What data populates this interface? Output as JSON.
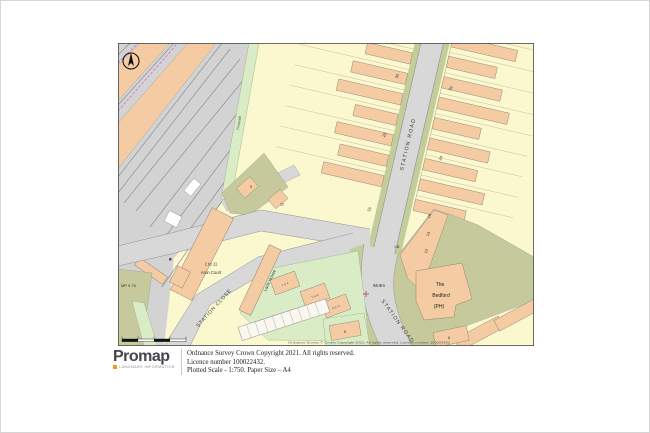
{
  "map": {
    "roads": {
      "station_road": "STATION ROAD",
      "station_road_lower": "STATION ROAD",
      "station_close": "STATION CLOSE",
      "footpath": "Footpath"
    },
    "buildings": {
      "arun_line1": "1 to 11",
      "arun_line2": "Arun Court",
      "lane_house": "Lane House",
      "bedford_line1": "The",
      "bedford_line2": "Bedford",
      "bedford_line3": "(PH)"
    },
    "markers": {
      "milepost": "MP 9.75",
      "letter_box": "LB",
      "spot_height": "66.9m"
    },
    "house_numbers": {
      "w1": "33",
      "w2": "25",
      "w3": "15",
      "e1": "34",
      "e2": "24",
      "e3": "16",
      "e4": "14",
      "e5": "12",
      "c1": "9",
      "c2": "12",
      "s1": "5",
      "s2": "6"
    },
    "flat_labels": [
      "1 to 4",
      "5 to 8",
      "9 to 12"
    ],
    "edge_copyright": "Ordnance Survey © Crown Copyright 2021. All rights reserved. Licence number 100022432",
    "colors": {
      "building": "#f4cba3",
      "garden": "#fbf8d0",
      "road": "#d8d8d8",
      "railway": "#d3d3d3",
      "green_space": "#d9ecc6",
      "verge": "#c2cd9a",
      "khaki": "#c6c99b",
      "boundary_magenta": "#d966d9"
    }
  },
  "footer": {
    "brand": "Promap",
    "brand_sub": "LANDMARK INFORMATION",
    "line1": "Ordnance Survey Crown Copyright 2021. All rights reserved.",
    "line2": "Licence number 100022432.",
    "line3": "Plotted Scale - 1:750. Paper Size – A4"
  }
}
